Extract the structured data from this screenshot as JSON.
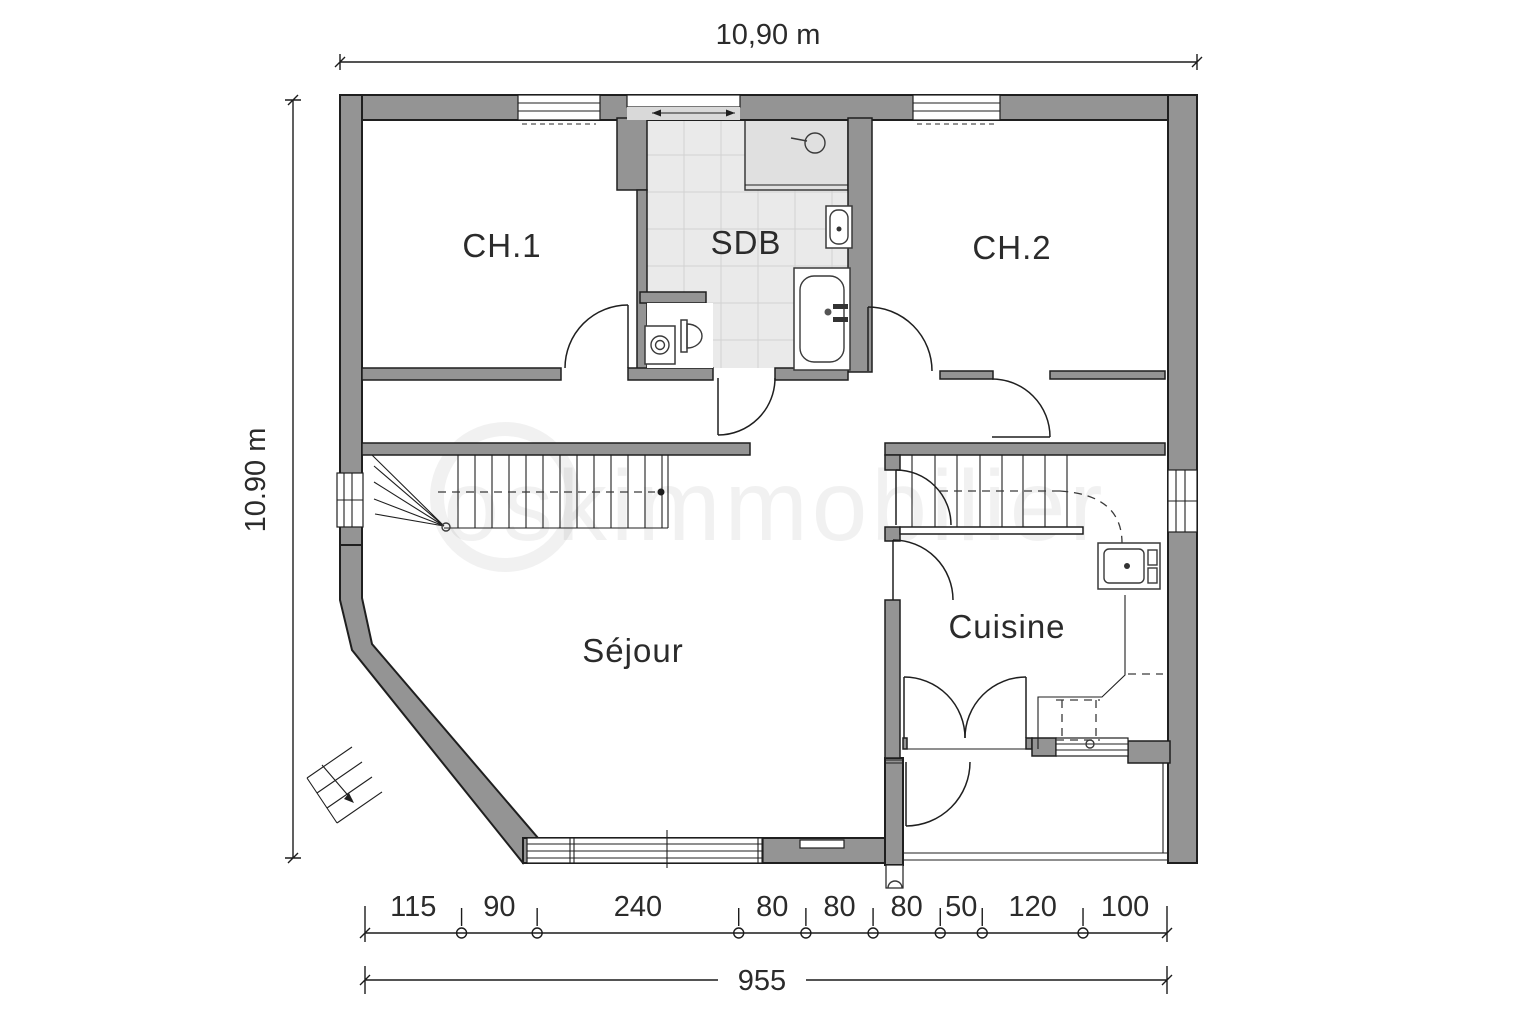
{
  "watermark": "oskimmobilier",
  "dimensions": {
    "top_width_label": "10,90 m",
    "left_height_label": "10.90 m",
    "bottom_total_cm": 955,
    "bottom_total_label": "955",
    "bottom_segments": [
      115,
      90,
      240,
      80,
      80,
      80,
      50,
      120,
      100
    ]
  },
  "rooms": [
    {
      "id": "ch1",
      "label": "CH.1"
    },
    {
      "id": "sdb",
      "label": "SDB"
    },
    {
      "id": "ch2",
      "label": "CH.2"
    },
    {
      "id": "sejour",
      "label": "Séjour"
    },
    {
      "id": "cuisine",
      "label": "Cuisine"
    }
  ],
  "fixtures": [
    "shower",
    "washbasin",
    "bathtub",
    "toilet",
    "washing-machine",
    "kitchen-sink",
    "staircase-main",
    "staircase-kitchen",
    "exterior-steps",
    "entry-door-arch"
  ],
  "colors": {
    "wall": "#949494",
    "line": "#1f1f1f",
    "tile": "#eaeaea",
    "tile_line": "#d2d2d2",
    "shower": "#e0e0e0",
    "light_band": "#d9d9d9",
    "text": "#2b2b2b",
    "watermark": "rgba(0,0,0,0.055)"
  }
}
